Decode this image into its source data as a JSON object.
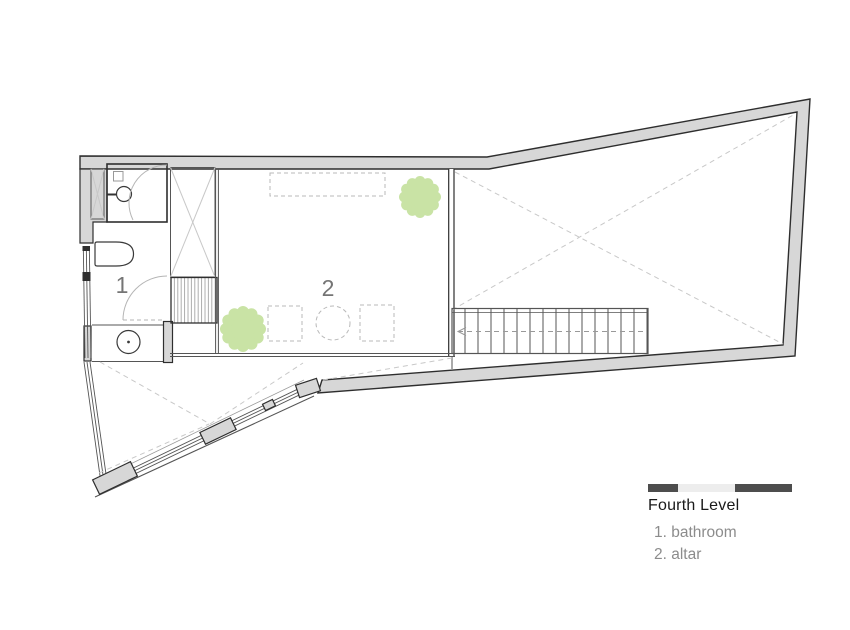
{
  "legend": {
    "title": "Fourth Level",
    "items": [
      {
        "text": "1. bathroom"
      },
      {
        "text": "2. altar"
      }
    ]
  },
  "plan": {
    "room_labels": {
      "bathroom": "1",
      "altar": "2"
    }
  },
  "icons": {
    "tree": "scalloped-green-circle",
    "bathtub": "rounded-rectangle",
    "washbasin": "circle-with-wall-stub",
    "vanity_sink": "circle-with-center-dot",
    "stairs": "tread-lines-with-dashed-arrow",
    "ladder_hatch": "striped-band",
    "void": "x-cross-diagonals",
    "door_swing": "quarter-arc",
    "scale_bar": "three-segment-bar"
  },
  "colors": {
    "bg": "#ffffff",
    "wall_fill": "#d7d7d7",
    "line_dark": "#2e2e2e",
    "line_mid": "#555555",
    "line_light": "#c8c8c8",
    "dash_gray": "#b9b9b9",
    "arc_gray": "#b5b5b5",
    "hatch_gray": "#a5a5a5",
    "tree_green": "#c9e3a5",
    "room_label": "#757575",
    "legend_text": "#8c8c8c",
    "legend_title": "#1a1a1a",
    "scalebar_dark": "#4d4d4d",
    "scalebar_light": "#ededed"
  }
}
